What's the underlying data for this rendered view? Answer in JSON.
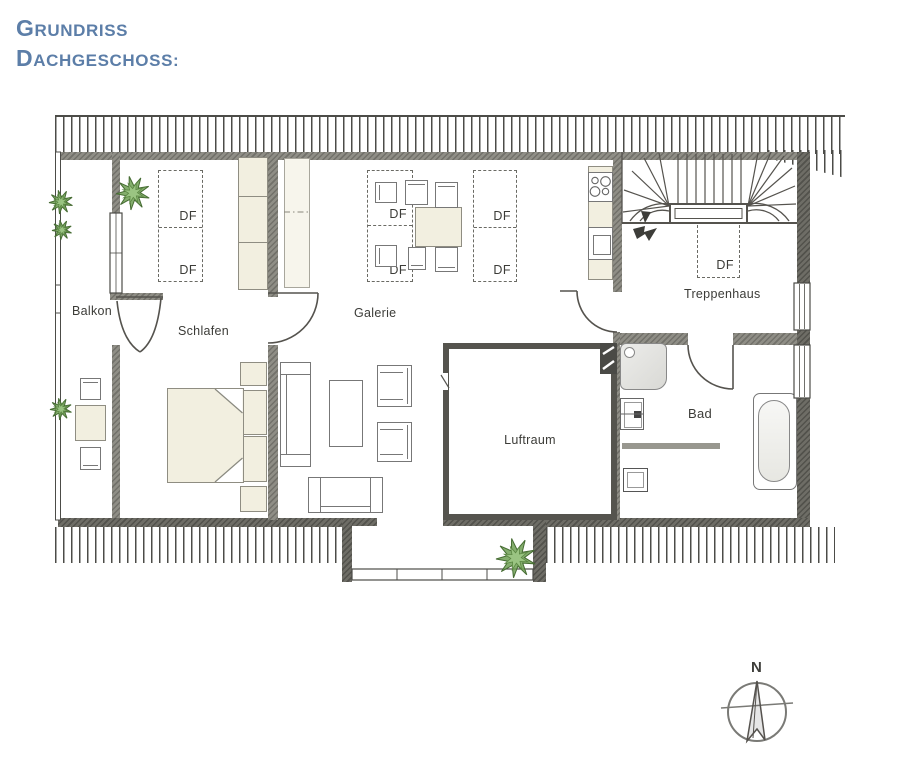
{
  "title": {
    "line1": "Grundriss",
    "line2": "Dachgeschoss:"
  },
  "labels": {
    "df": "DF"
  },
  "rooms": {
    "balkon": "Balkon",
    "schlafen": "Schlafen",
    "galerie": "Galerie",
    "treppenhaus": "Treppenhaus",
    "luftraum": "Luftraum",
    "bad": "Bad"
  },
  "compass": {
    "north": "N"
  },
  "colors": {
    "title_blue": "#5c7ea8",
    "plant_green": "#6fa053",
    "wall_gray": "#8f8e86",
    "line_dark": "#4c4c48",
    "furniture_beige": "#f2efe0"
  }
}
